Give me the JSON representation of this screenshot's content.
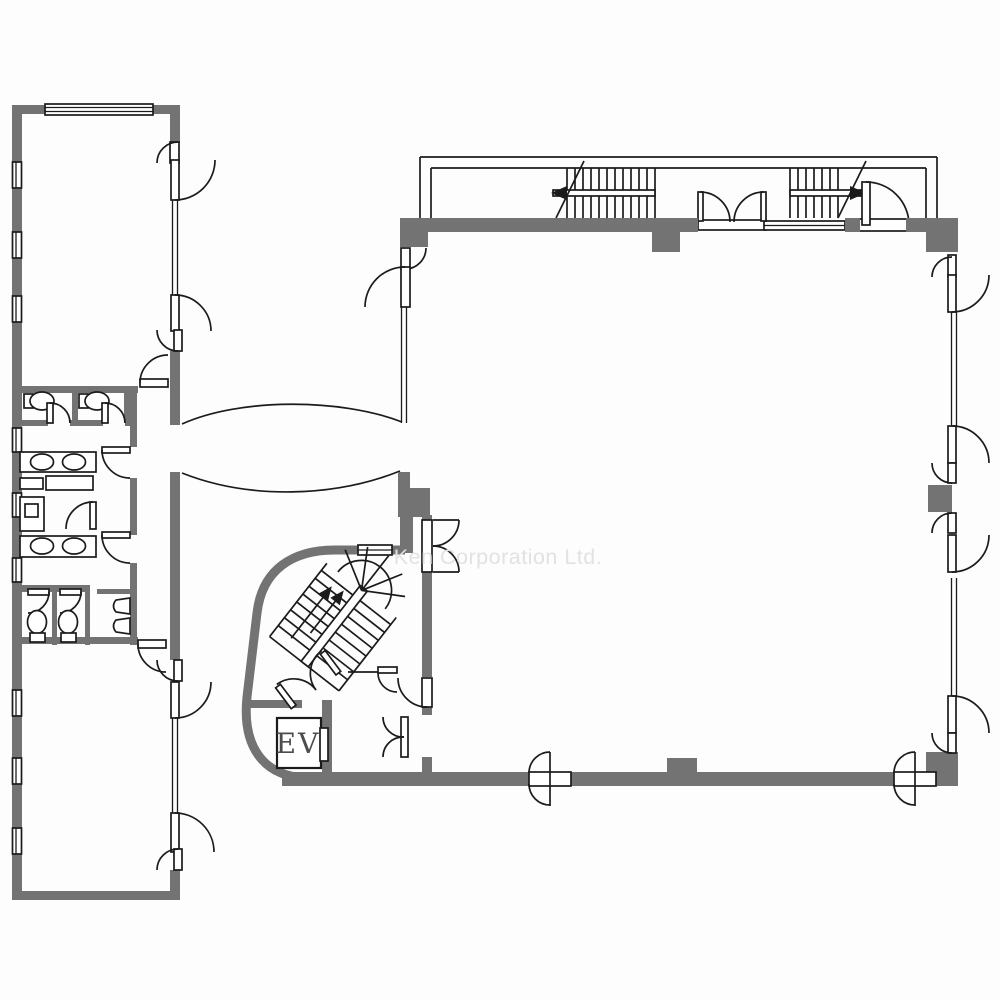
{
  "title": "Office building floor plan",
  "watermark": {
    "text": "Ken Corporation Ltd."
  },
  "labels": {
    "elevator": "EV"
  },
  "colors": {
    "wall": "#737373",
    "line": "#1b1b1b",
    "watermark": "#e2e2e2",
    "background": "#fcfdfc"
  },
  "fixtures": {
    "toilets": 4,
    "sinks": 4,
    "urinals": 2,
    "staircases": 2,
    "elevators": 1,
    "elevator_label": "EV"
  }
}
